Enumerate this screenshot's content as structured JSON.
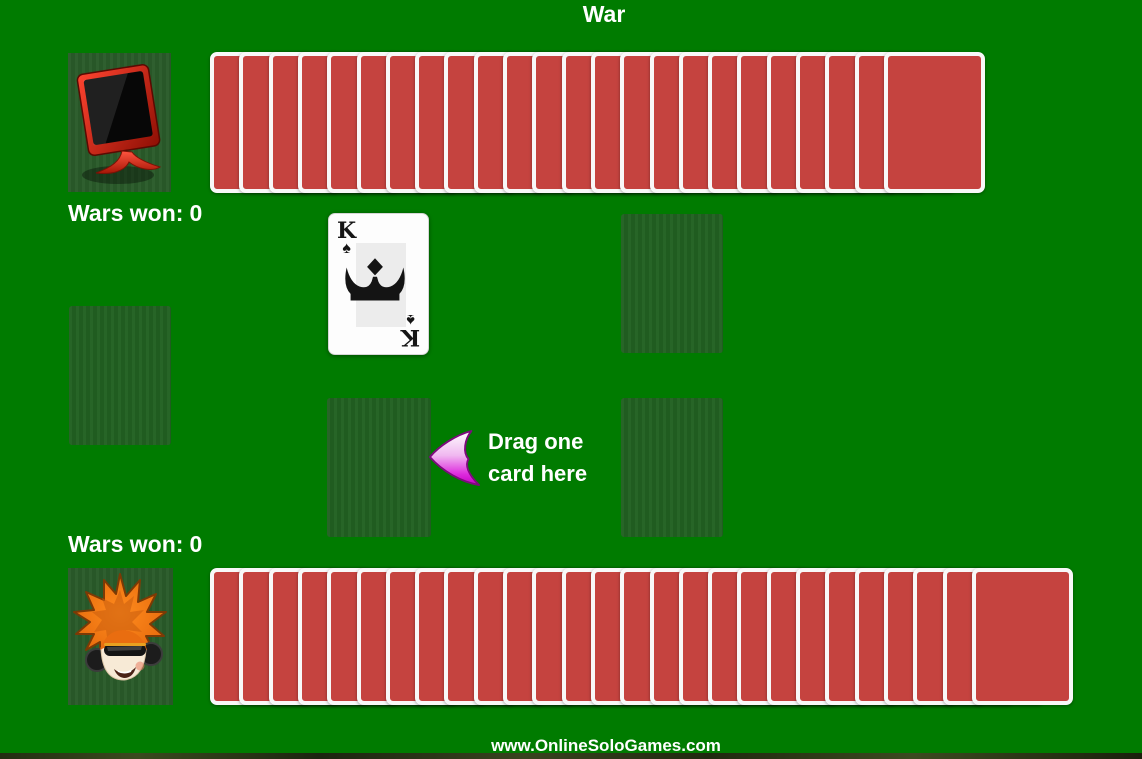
{
  "title": "War",
  "opponent": {
    "avatar_icon": "computer-monitor",
    "wars_won_label": "Wars won:",
    "wars_won_value": "0",
    "cards_in_stack": 24
  },
  "player": {
    "avatar_icon": "boy-with-headphones",
    "wars_won_label": "Wars won:",
    "wars_won_value": "0",
    "cards_in_stack": 27
  },
  "battlefield": {
    "opponent_played_card": {
      "rank": "K",
      "suit": "spades",
      "suit_symbol": "♠"
    },
    "hint_line1": "Drag one",
    "hint_line2": "card here"
  },
  "footer_url": "www.OnlineSoloGames.com",
  "colors": {
    "table_green": "#007b00",
    "spot_green": "#226122",
    "card_back_red": "#c5433f",
    "card_border_white": "#f8f8f8",
    "text_white": "#ffffff",
    "arrow_magenta": "#cc00cc"
  }
}
